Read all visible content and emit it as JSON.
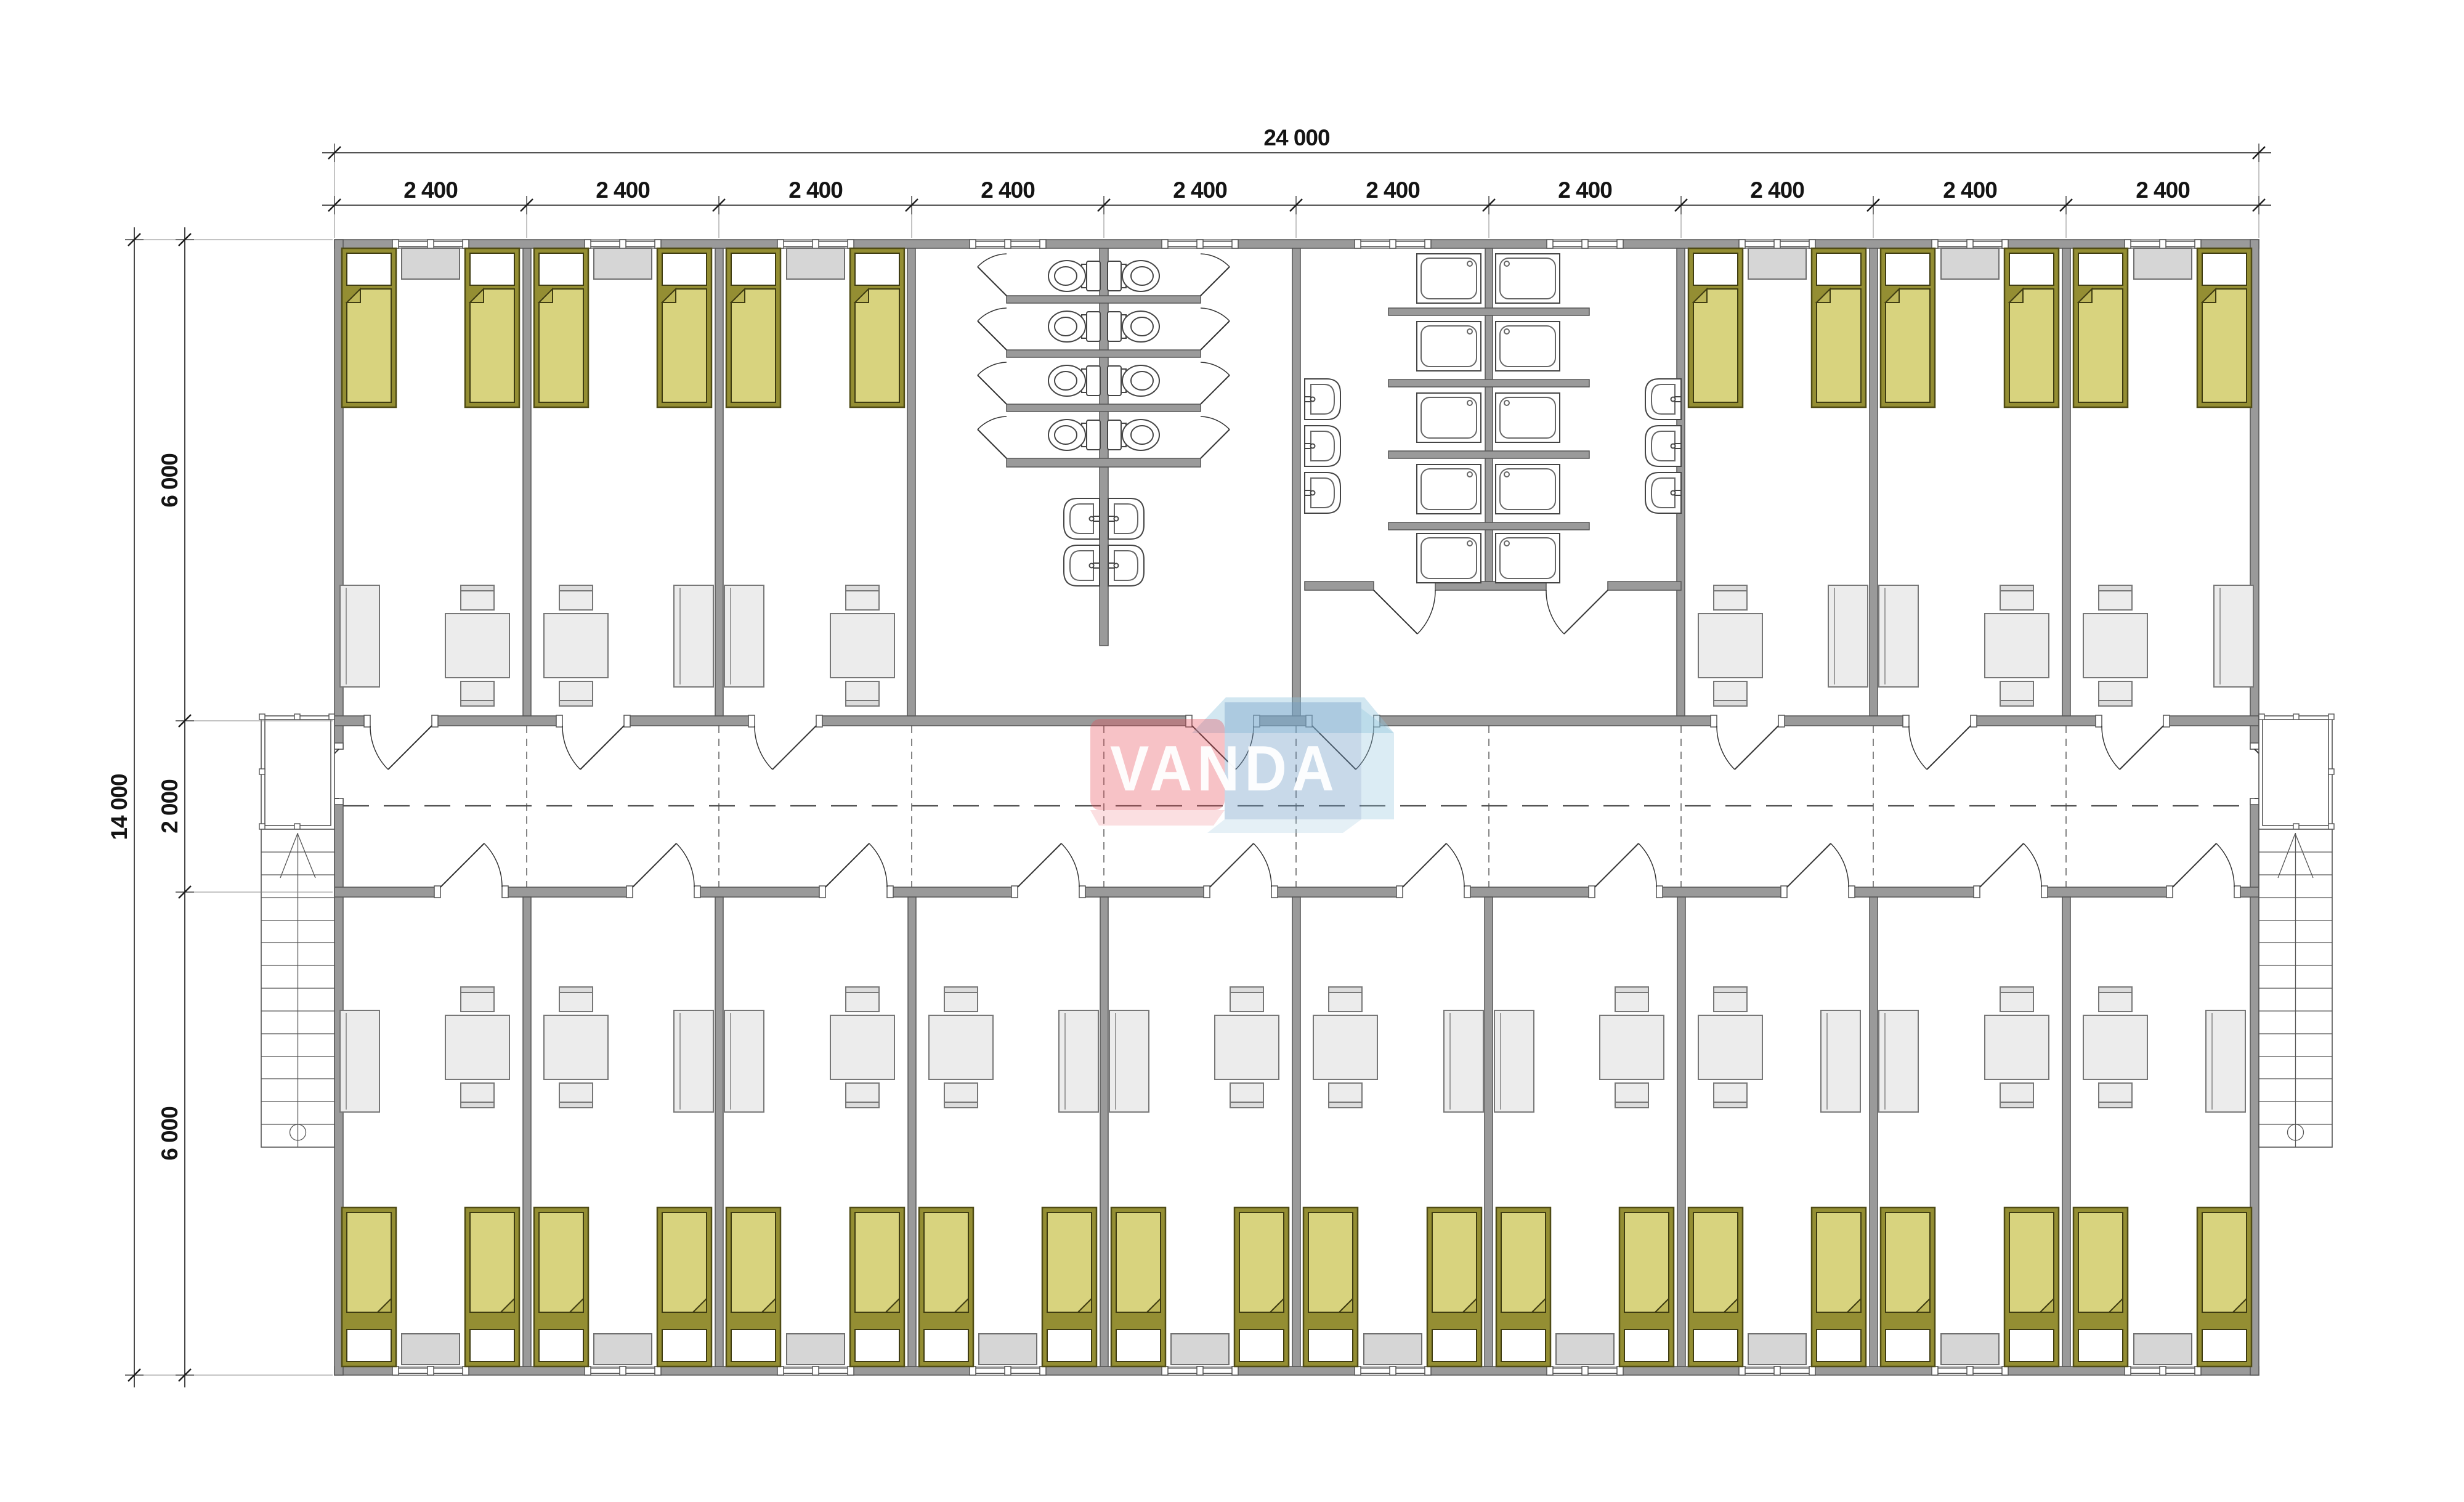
{
  "watermark": {
    "text": "VANDA",
    "pink": "#e94b59",
    "blue": "#6f9cc6",
    "light_blue": "#8fc3dd"
  },
  "dimensions": {
    "overall_width": "24 000",
    "width_segments": [
      "2 400",
      "2 400",
      "2 400",
      "2 400",
      "2 400",
      "2 400",
      "2 400",
      "2 400",
      "2 400",
      "2 400"
    ],
    "overall_height": "14 000",
    "height_segments": [
      "6 000",
      "2 000",
      "6 000"
    ]
  },
  "colors": {
    "wall": "#9a9a9a",
    "wall_edge": "#565656",
    "bed_fill": "#d8d37e",
    "bed_frame": "#948e33",
    "pillow": "#ffffff",
    "furniture": "#ececec",
    "window_sill": "#d6d6d6",
    "line": "#3d3d3d"
  },
  "inventory": {
    "bedrooms": 16,
    "beds": 32,
    "tables": 16,
    "wardrobes": 16,
    "toilet_stalls": 8,
    "shower_cabins": 10,
    "wash_basins": 10,
    "staircases": 2,
    "entrance_porches": 2
  }
}
